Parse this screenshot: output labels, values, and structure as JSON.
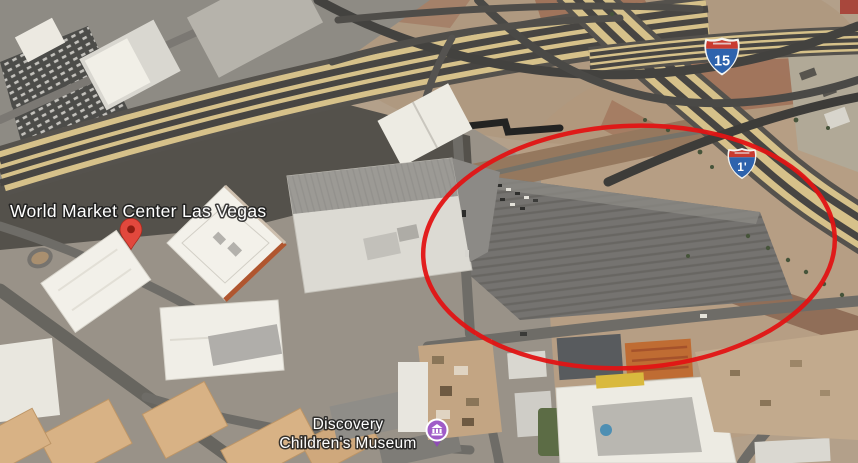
{
  "map": {
    "view": "satellite",
    "place_label": "World Market Center Las Vegas",
    "museum_label_line1": "Discovery",
    "museum_label_line2": "Children's Museum",
    "shield_main": "15",
    "shield_small": "1'",
    "annotation": {
      "shape": "ellipse",
      "color": "#e11414"
    },
    "colors": {
      "pin": "#e2483d",
      "pin_dot": "#8f1d12",
      "museum_icon": "#a05cc8",
      "shield_blue": "#2e63ad",
      "shield_red": "#c93b30",
      "freeway_tan": "#d6c18a",
      "lot_gray": "#757370"
    }
  }
}
